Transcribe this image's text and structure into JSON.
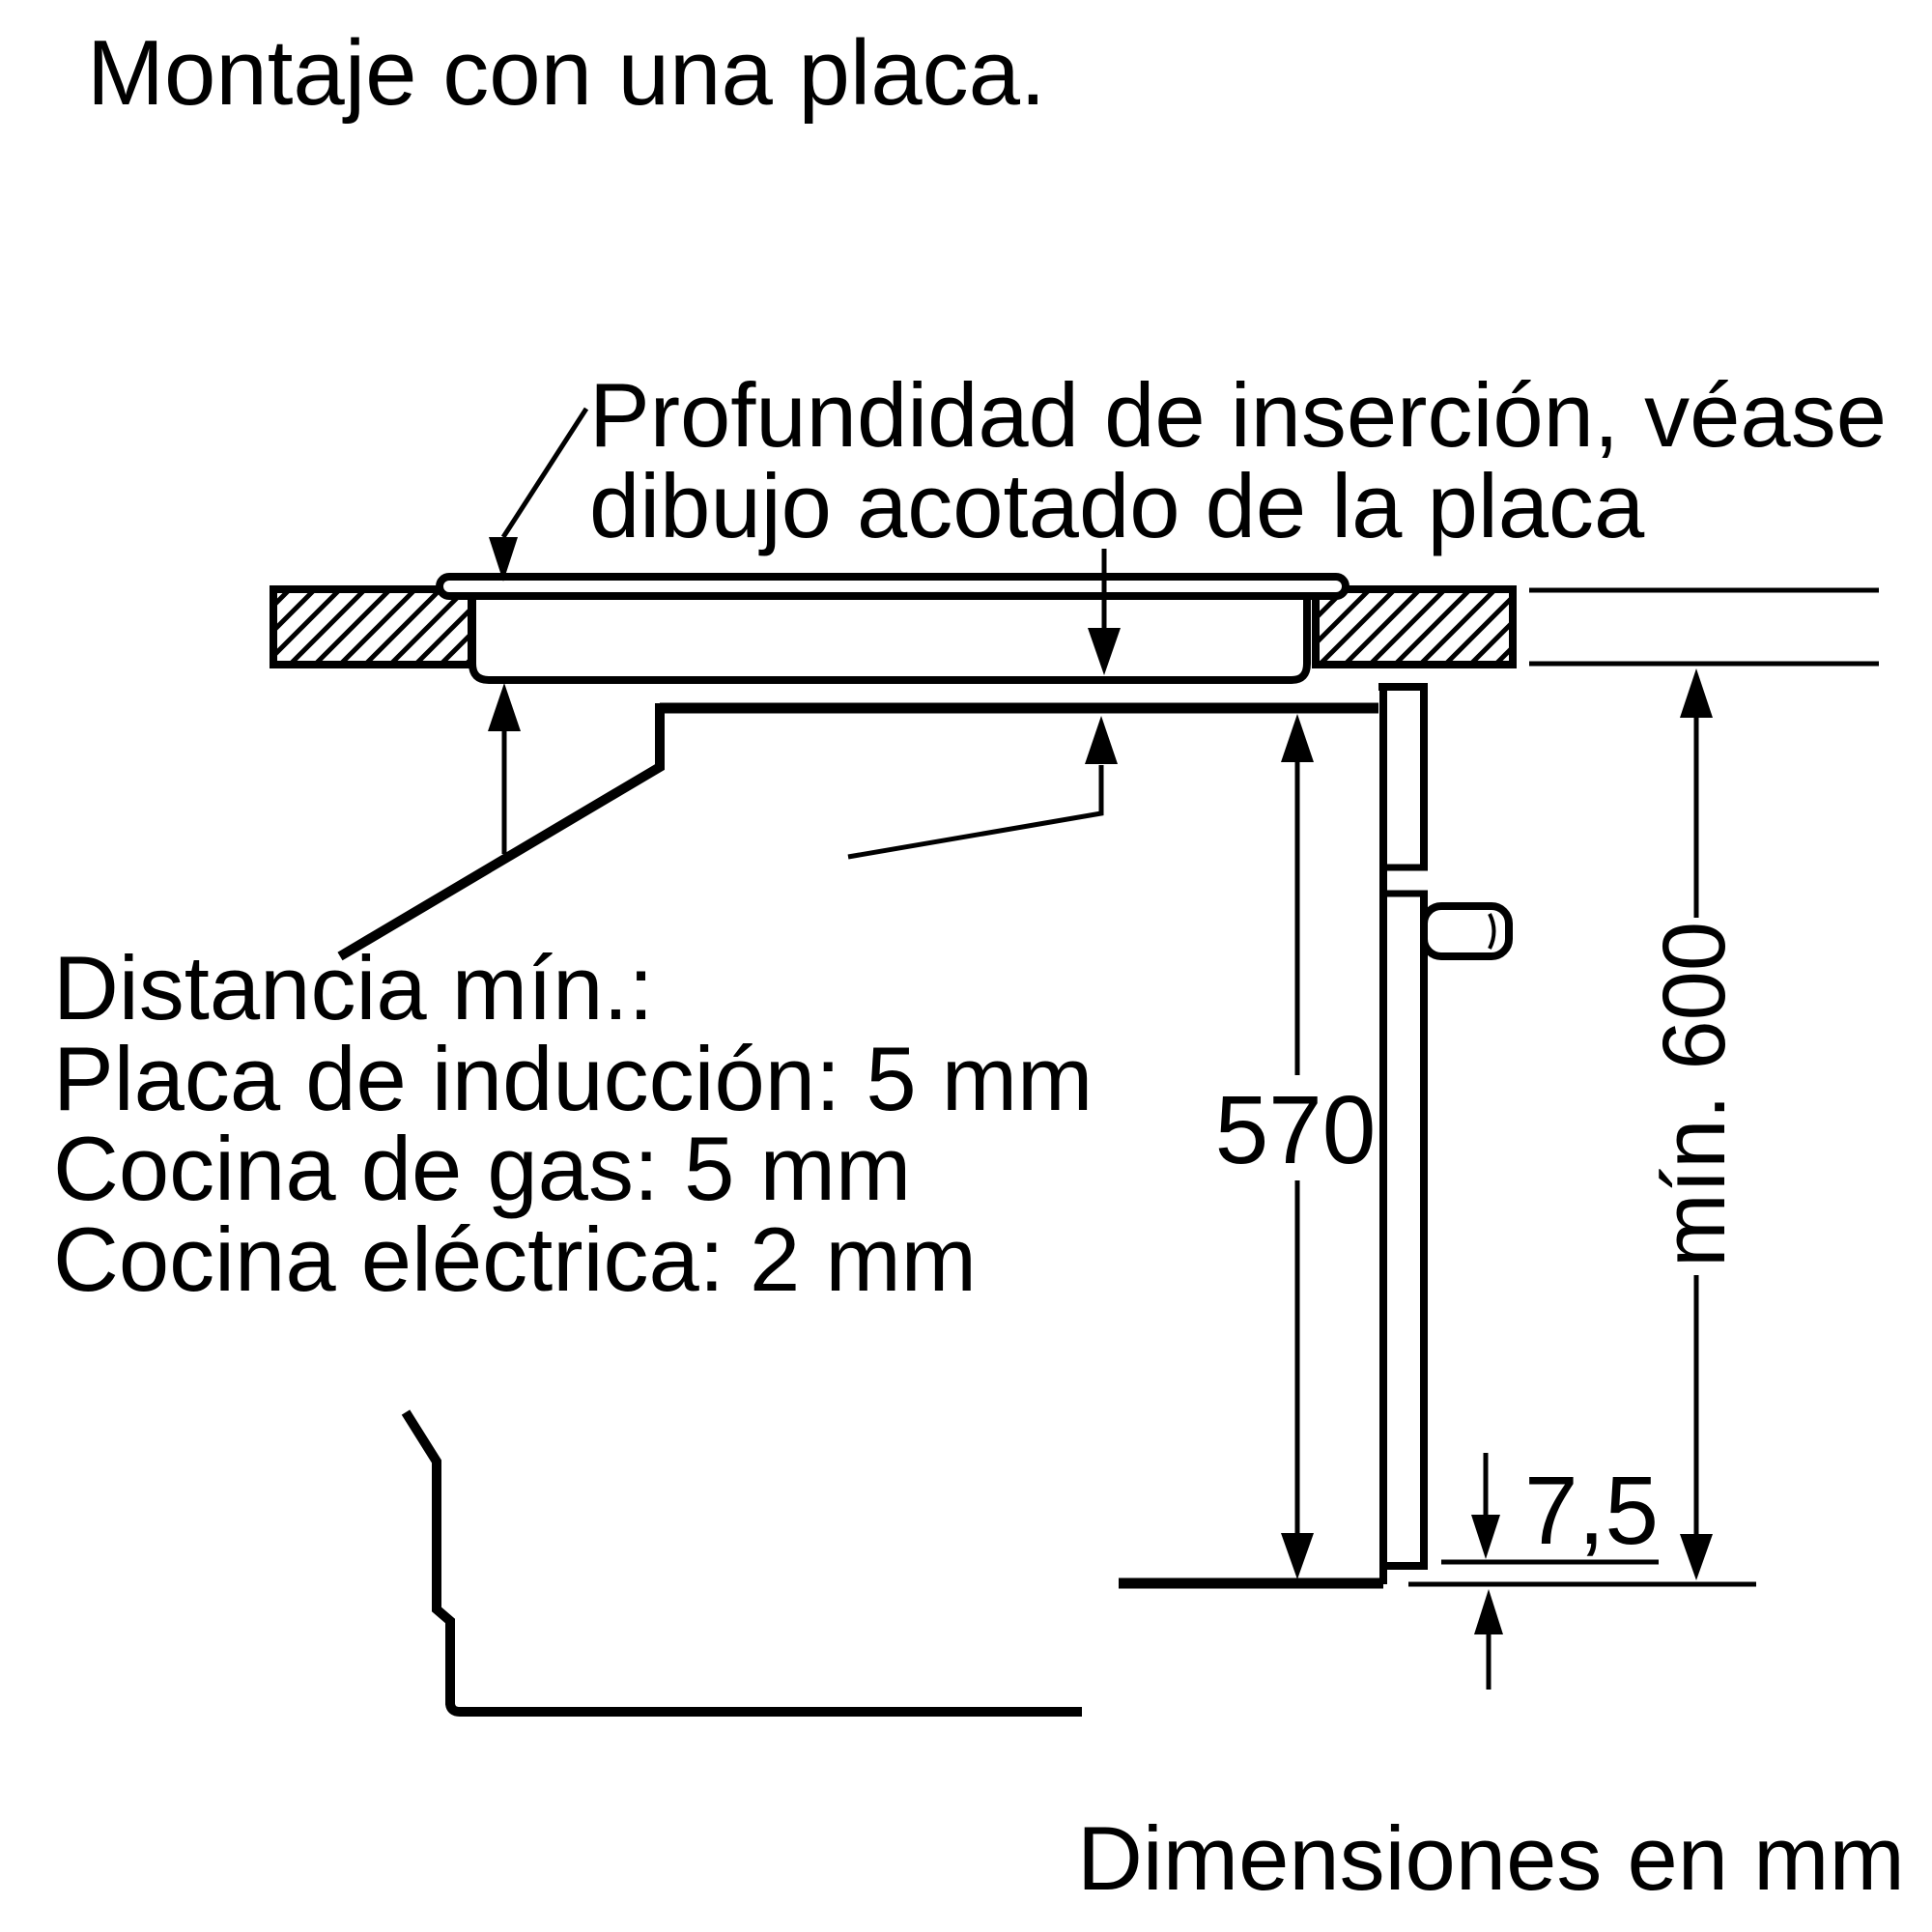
{
  "title": "Montaje con una placa.",
  "colors": {
    "ink": "#000000",
    "background": "#ffffff"
  },
  "annotations": {
    "insertion_depth": {
      "line1": "Profundidad de inserción, véase",
      "line2": "dibujo acotado de la placa"
    },
    "min_distance": {
      "heading": "Distancia mín.:",
      "items": [
        "Placa de inducción: 5 mm",
        "Cocina de gas: 5 mm",
        "Cocina eléctrica: 2 mm"
      ]
    }
  },
  "dimensions": {
    "oven_height": "570",
    "niche_min_height": "mín. 600",
    "bottom_gap": "7,5"
  },
  "footer": "Dimensiones en mm"
}
